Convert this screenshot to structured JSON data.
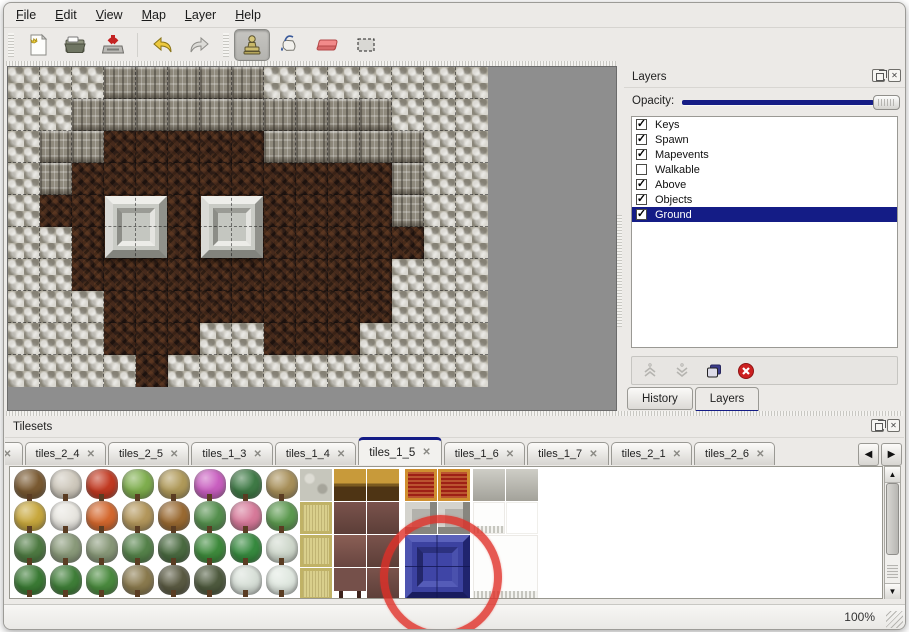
{
  "menubar": {
    "items": [
      {
        "first": "F",
        "rest": "ile"
      },
      {
        "first": "E",
        "rest": "dit"
      },
      {
        "first": "V",
        "rest": "iew"
      },
      {
        "first": "M",
        "rest": "ap"
      },
      {
        "first": "L",
        "rest": "ayer"
      },
      {
        "first": "H",
        "rest": "elp"
      }
    ]
  },
  "toolbar": {
    "tools": [
      "new-file",
      "open-file",
      "save-file",
      "undo",
      "redo",
      "stamp-tool",
      "fill-tool",
      "eraser-tool",
      "rect-select-tool"
    ],
    "active_tool": "stamp-tool"
  },
  "map": {
    "tile_size": 32,
    "cols": 15,
    "rows": 10,
    "legend": {
      "S": "stone-ground",
      "W": "cliff-wall",
      "F": "cave-floor"
    },
    "grid": [
      "SSSWWWWWSSSSSSS",
      "SSWWWWWWWWWWSSS",
      "SWWFFFFFWWWWWSS",
      "SWFFFFFFFFFFWSS",
      "SFFFFFFFFFFFWSS",
      "SSFFFFFFFFFFFSS",
      "SSFFFFFFFFFFSSS",
      "SSSFFFFFFFFFSSS",
      "SSSFFFSSFFFSSSS",
      "SSSSFSSSSSSSSSS"
    ],
    "pillars": [
      {
        "col": 3,
        "row": 4
      },
      {
        "col": 6,
        "row": 4
      }
    ]
  },
  "layers_panel": {
    "title": "Layers",
    "window_buttons": [
      "float",
      "close"
    ],
    "opacity_label": "Opacity:",
    "opacity_fraction": 1.0,
    "layers": [
      {
        "name": "Keys",
        "checked": true,
        "selected": false
      },
      {
        "name": "Spawn",
        "checked": true,
        "selected": false
      },
      {
        "name": "Mapevents",
        "checked": true,
        "selected": false
      },
      {
        "name": "Walkable",
        "checked": false,
        "selected": false
      },
      {
        "name": "Above",
        "checked": true,
        "selected": false
      },
      {
        "name": "Objects",
        "checked": true,
        "selected": false
      },
      {
        "name": "Ground",
        "checked": true,
        "selected": true
      }
    ],
    "buttons": [
      "raise-layer",
      "lower-layer",
      "duplicate-layer",
      "delete-layer"
    ],
    "tabs": [
      {
        "label": "History",
        "active": false
      },
      {
        "label": "Layers",
        "active": true
      }
    ]
  },
  "tilesets_panel": {
    "title": "Tilesets",
    "window_buttons": [
      "float",
      "close"
    ],
    "tabs": [
      {
        "label": "3",
        "clipped": true,
        "active": false
      },
      {
        "label": "tiles_2_4",
        "active": false
      },
      {
        "label": "tiles_2_5",
        "active": false
      },
      {
        "label": "tiles_1_3",
        "active": false
      },
      {
        "label": "tiles_1_4",
        "active": false
      },
      {
        "label": "tiles_1_5",
        "active": true
      },
      {
        "label": "tiles_1_6",
        "active": false
      },
      {
        "label": "tiles_1_7",
        "active": false
      },
      {
        "label": "tiles_2_1",
        "active": false
      },
      {
        "label": "tiles_2_6",
        "active": false
      }
    ],
    "nav": [
      "scroll-tabs-left",
      "scroll-tabs-right"
    ],
    "plants": [
      [
        "#7a5a32",
        "#cfc9bd",
        "#c23a22",
        "#7fae4e",
        "#b09a5a",
        "#c95fc0",
        "#3f7a46",
        "#a8905a"
      ],
      [
        "#c8a83e",
        "#e8e6e0",
        "#d4682e",
        "#b3975c",
        "#9a6a32",
        "#55904e",
        "#d77a9a",
        "#5d9a50"
      ],
      [
        "#4e7a42",
        "#8a9a7a",
        "#889878",
        "#55824a",
        "#4a6a40",
        "#3e8a3c",
        "#378a3f",
        "#cfd8cc"
      ],
      [
        "#3a7a34",
        "#3f7e38",
        "#4a8a3e",
        "#8a7a4e",
        "#5a5a42",
        "#4e5a3e",
        "#d8e0d8",
        "#e0e8e0"
      ]
    ],
    "tiles": [
      {
        "x": 290,
        "y": 2,
        "w": 32,
        "h": 32,
        "kind": "stone"
      },
      {
        "x": 324,
        "y": 2,
        "w": 32,
        "h": 32,
        "kind": "table-gold"
      },
      {
        "x": 357,
        "y": 2,
        "w": 32,
        "h": 32,
        "kind": "table-gold"
      },
      {
        "x": 395,
        "y": 2,
        "w": 32,
        "h": 32,
        "kind": "carpet-red"
      },
      {
        "x": 428,
        "y": 2,
        "w": 32,
        "h": 32,
        "kind": "carpet-red"
      },
      {
        "x": 463,
        "y": 2,
        "w": 32,
        "h": 32,
        "kind": "silver"
      },
      {
        "x": 496,
        "y": 2,
        "w": 32,
        "h": 32,
        "kind": "silver"
      },
      {
        "x": 290,
        "y": 35,
        "w": 32,
        "h": 32,
        "kind": "mat-tan"
      },
      {
        "x": 324,
        "y": 35,
        "w": 32,
        "h": 32,
        "kind": "maroon"
      },
      {
        "x": 357,
        "y": 35,
        "w": 32,
        "h": 32,
        "kind": "maroon"
      },
      {
        "x": 395,
        "y": 35,
        "w": 32,
        "h": 32,
        "kind": "frame-gray"
      },
      {
        "x": 428,
        "y": 35,
        "w": 32,
        "h": 32,
        "kind": "frame-gray"
      },
      {
        "x": 463,
        "y": 35,
        "w": 32,
        "h": 32,
        "kind": "white-fringe"
      },
      {
        "x": 496,
        "y": 35,
        "w": 32,
        "h": 32,
        "kind": "white"
      },
      {
        "x": 290,
        "y": 68,
        "w": 32,
        "h": 32,
        "kind": "mat-tan"
      },
      {
        "x": 324,
        "y": 68,
        "w": 32,
        "h": 32,
        "kind": "maroon-light"
      },
      {
        "x": 357,
        "y": 68,
        "w": 32,
        "h": 32,
        "kind": "maroon"
      },
      {
        "x": 395,
        "y": 68,
        "w": 65,
        "h": 64,
        "kind": "blue-block"
      },
      {
        "x": 463,
        "y": 68,
        "w": 65,
        "h": 64,
        "kind": "white-fringe"
      },
      {
        "x": 290,
        "y": 101,
        "w": 32,
        "h": 32,
        "kind": "mat-tan"
      },
      {
        "x": 324,
        "y": 101,
        "w": 32,
        "h": 32,
        "kind": "maroon-legs"
      },
      {
        "x": 357,
        "y": 101,
        "w": 32,
        "h": 32,
        "kind": "maroon"
      }
    ],
    "annotation": {
      "type": "hand-drawn-circle",
      "color": "#e03028",
      "target": "blue-block tile"
    }
  },
  "statusbar": {
    "zoom": "100%"
  },
  "colors": {
    "selection_navy": "#141c86",
    "panel_bg": "#eceae7",
    "map_backdrop": "#8e8e8e"
  }
}
